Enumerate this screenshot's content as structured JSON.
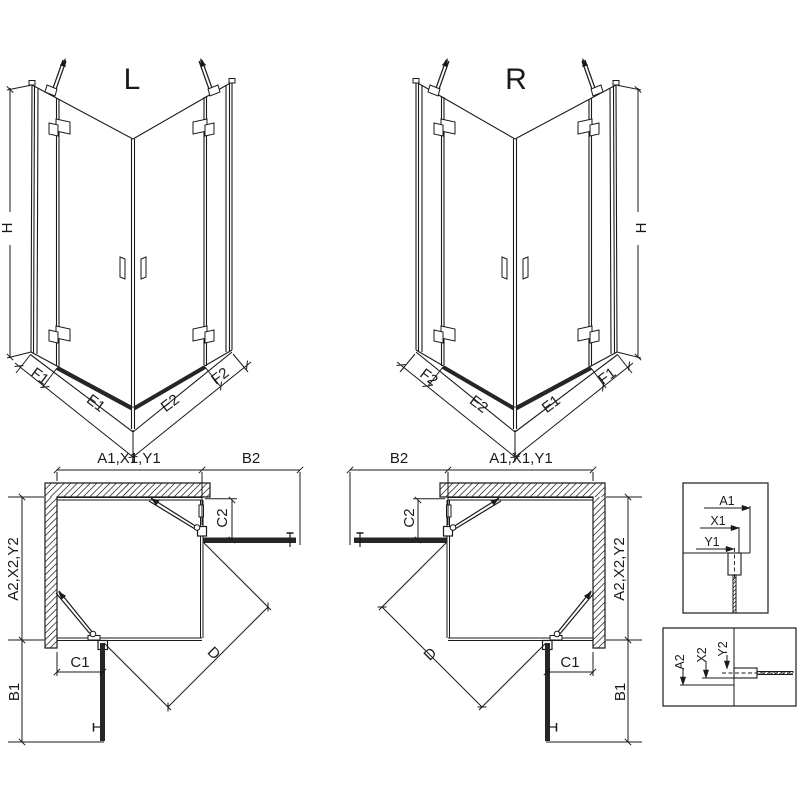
{
  "colors": {
    "line": "#1a1a1a",
    "thick": "#262626",
    "hatch": "#2a2a2a",
    "background": "#ffffff"
  },
  "figure_left": {
    "title": "L",
    "height": "H",
    "f1": "F1",
    "e1": "E1",
    "e2": "E2",
    "f2": "F2"
  },
  "figure_right": {
    "title": "R",
    "height": "H",
    "f1": "F1",
    "e1": "E1",
    "e2": "E2",
    "f2": "F2"
  },
  "plan_left": {
    "width_top": "A1,X1,Y1",
    "door_top": "B2",
    "fixed_top": "C2",
    "width_side": "A2,X2,Y2",
    "fixed_bottom": "C1",
    "door_bottom": "B1",
    "diagonal": "D"
  },
  "plan_right": {
    "width_top": "A1,X1,Y1",
    "door_top": "B2",
    "fixed_top": "C2",
    "width_side": "A2,X2,Y2",
    "fixed_bottom": "C1",
    "door_bottom": "B1",
    "diagonal": "D"
  },
  "detail_top": {
    "a": "A1",
    "x": "X1",
    "y": "Y1"
  },
  "detail_bottom": {
    "a": "A2",
    "x": "X2",
    "y": "Y2"
  }
}
